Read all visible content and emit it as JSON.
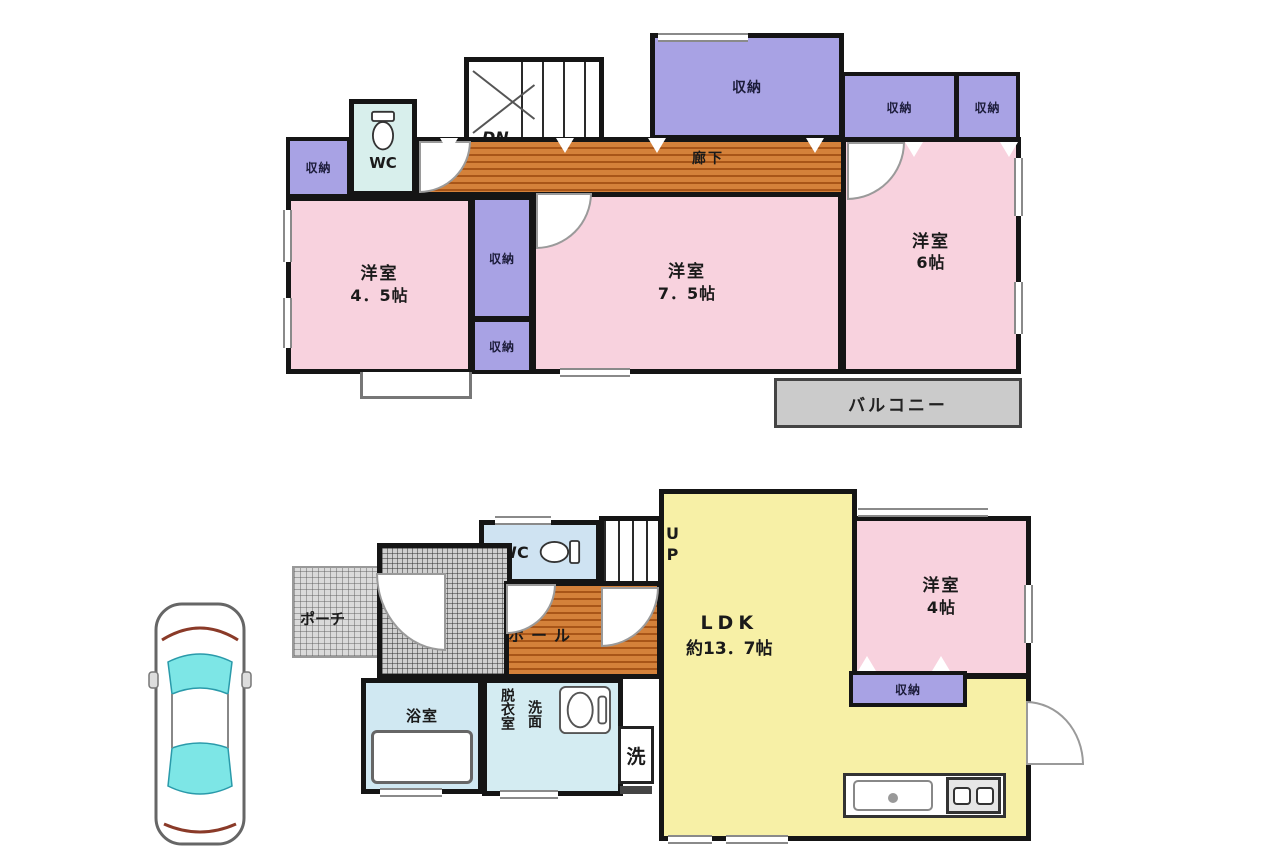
{
  "colors": {
    "wall": "#151515",
    "room_pink": "#f8d2de",
    "closet_purple": "#a8a2e4",
    "wood_floor": "#c8702c",
    "ldk_yellow": "#f7f0a6",
    "wc_cyan": "#d8efec",
    "bath_blue": "#d0e8f2",
    "balcony_gray": "#cbcbcb",
    "car_glass_cyan": "#7de6e6"
  },
  "floor2": {
    "bedroom_45": {
      "name": "洋室",
      "size": "4．5帖"
    },
    "bedroom_75": {
      "name": "洋室",
      "size": "7．5帖"
    },
    "bedroom_6": {
      "name": "洋室",
      "size": "6帖"
    },
    "hallway": "廊下",
    "stairs_down": "DN",
    "wc": "WC",
    "closet": "収納",
    "balcony": "バルコニー"
  },
  "floor1": {
    "ldk": {
      "name": "LDK",
      "size": "約13．7帖"
    },
    "bedroom_4": {
      "name": "洋室",
      "size": "4帖"
    },
    "porch": "ポーチ",
    "entrance": "玄関",
    "hall": "ホール",
    "stairs_up": "UP",
    "wc": "WC",
    "bathroom": "浴室",
    "dressing_room": "脱衣室",
    "washbasin": "洗面",
    "laundry": "洗",
    "closet": "収納"
  }
}
